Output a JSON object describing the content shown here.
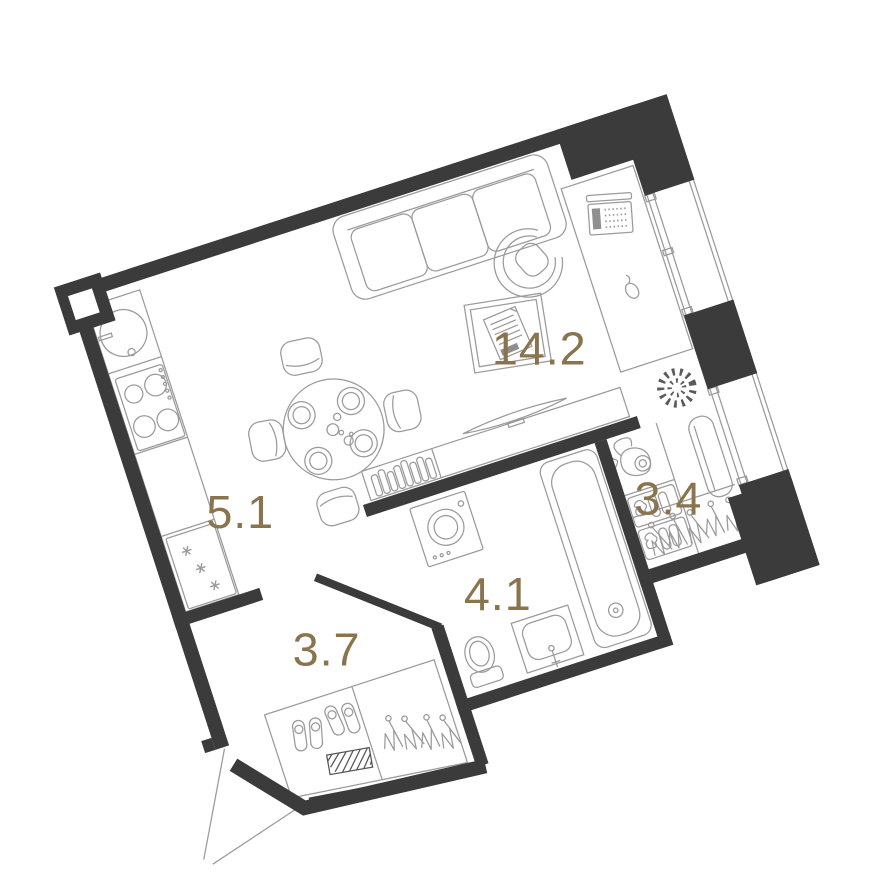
{
  "title": "studio-apartment-floor-plan",
  "colors": {
    "background": "#ffffff",
    "wall": "#3b3b3b",
    "furniture_line": "#9b9b9b",
    "dark_line": "#555555",
    "label": "#8a744d"
  },
  "rooms": {
    "living": {
      "name": "living-room",
      "label": "14.2"
    },
    "kitchen": {
      "name": "kitchen-area",
      "label": "5.1"
    },
    "hall": {
      "name": "dressing-hall",
      "label": "3.4"
    },
    "bathroom": {
      "name": "bathroom",
      "label": "4.1"
    },
    "entry": {
      "name": "entry-hall",
      "label": "3.7"
    }
  },
  "furniture": [
    {
      "room": "kitchen",
      "items": [
        "round-sink",
        "cooktop-4-burners",
        "counter",
        "fridge-with-snowflakes"
      ]
    },
    {
      "room": "living",
      "items": [
        "dining-table-4-plates",
        "chair-x4",
        "sofa-3-seat",
        "coffee-table-with-magazine",
        "desk",
        "office-chair",
        "laptop",
        "mouse",
        "plant",
        "tv-console-with-books",
        "tv"
      ]
    },
    {
      "room": "bathroom",
      "items": [
        "washing-machine",
        "bathtub",
        "washbasin",
        "toilet"
      ]
    },
    {
      "room": "hall",
      "items": [
        "vacuum-cleaner",
        "clothes-shelf-x2",
        "radiator",
        "hanger-rail"
      ]
    },
    {
      "room": "entry",
      "items": [
        "shoe-cabinet",
        "slippers-2-pairs",
        "doormat",
        "hanger-closet",
        "entry-door-swing"
      ]
    }
  ],
  "structure": [
    "windows-right-wall",
    "window-pier",
    "corner-columns",
    "chamfer-wall",
    "door-openings"
  ]
}
